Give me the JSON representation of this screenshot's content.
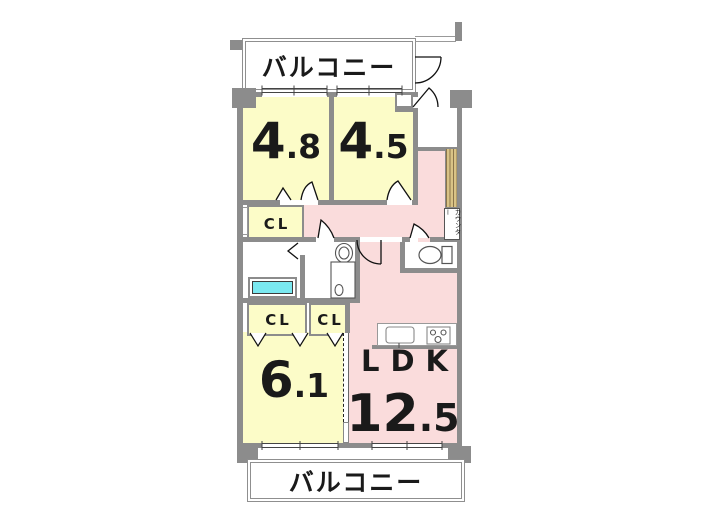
{
  "colors": {
    "wall": "#8C8C8C",
    "yellow": "#FCFCC8",
    "pink": "#FADCDC",
    "cyan": "#7AE8F0",
    "tan": "#D9C386",
    "ink": "#1A1A1A"
  },
  "balcony_top": {
    "label": "バルコニー"
  },
  "balcony_bottom": {
    "label": "バルコニー"
  },
  "rooms": {
    "bedroom1": {
      "area_int": "4",
      "area_dec": ".8"
    },
    "bedroom2": {
      "area_int": "4",
      "area_dec": ".5"
    },
    "bedroom3": {
      "area_int": "6",
      "area_dec": ".1"
    },
    "ldk": {
      "name": "LDK",
      "area_int": "12",
      "area_dec": ".5"
    }
  },
  "closets": {
    "hall": "CL",
    "left": "CL",
    "right": "CL"
  },
  "counter": {
    "label": "カウンター"
  },
  "fixtures": [
    "bathtub",
    "washbasin",
    "washing-machine",
    "toilet",
    "kitchen-sink",
    "stove",
    "entrance-door",
    "sliding-door"
  ]
}
